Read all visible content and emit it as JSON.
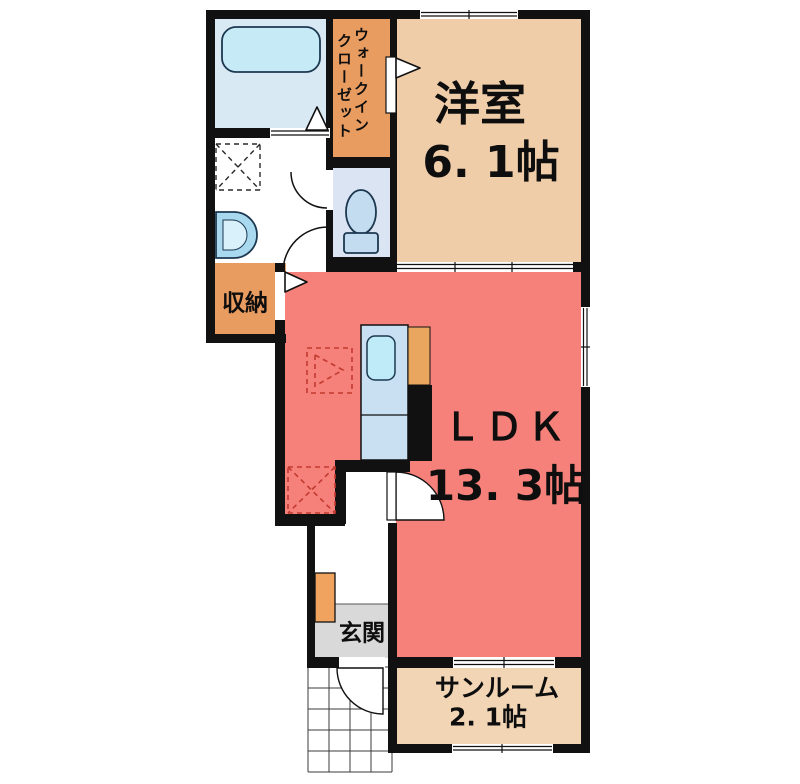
{
  "rooms": {
    "western_room": {
      "label": "洋室",
      "size": "6. 1帖"
    },
    "ldk": {
      "label": "ＬＤＫ",
      "size": "13. 3帖"
    },
    "sunroom": {
      "label": "サンルーム",
      "size": "2. 1帖"
    },
    "entrance": {
      "label": "玄関"
    },
    "storage": {
      "label": "収納"
    },
    "walk_in_closet": {
      "label_line1": "ウォークイン",
      "label_line2": "クローゼット"
    }
  },
  "colors": {
    "c-wall": "#111111",
    "c-western": "#F0CDA9",
    "c-ldk": "#F6807A",
    "c-sunroom": "#F2D5B5",
    "c-closet": "#E99C60",
    "c-cabinet": "#F0A35F",
    "c-stove": "#E9A65E",
    "c-bath-floor": "#D9E9F4",
    "c-toilet-floor": "#DAE4F2",
    "c-entrance": "#D9D9D9",
    "c-fixture": "#C6EBF7",
    "c-fixture2": "#C4DCF0",
    "c-counter": "#C9E0F2",
    "c-sink": "#A9D9EE",
    "c-dashed": "#C23A30"
  }
}
